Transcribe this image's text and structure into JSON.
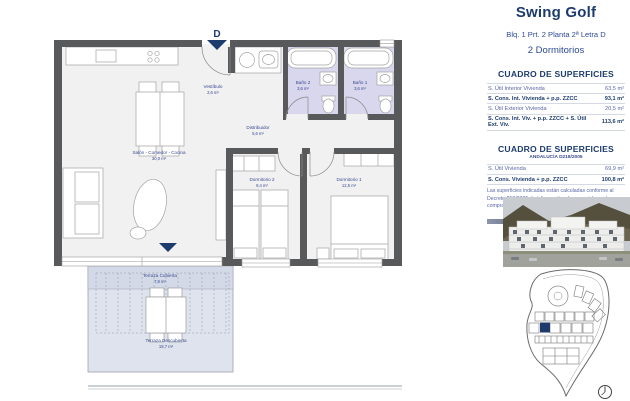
{
  "colors": {
    "navy": "#1d3c6e",
    "blue_text": "#5a66a8",
    "wall_gray": "#58595b",
    "room_fill": "#f1f1f2",
    "bath_fill": "#d9d7ed",
    "terrace_fill": "#dfe3ed",
    "marker_blue": "#1e3a6d"
  },
  "header": {
    "project": "Swing Golf",
    "unit": "Blq. 1 Prt. 2 Planta 2ª Letra D",
    "bedrooms": "2 Dormitorios"
  },
  "table1": {
    "title": "CUADRO DE SUPERFICIES",
    "rows": [
      {
        "label": "S. Útil Interior Vivienda",
        "value": "63,5 m²"
      },
      {
        "label": "S. Cons. Int. Vivienda + p.p. ZZCC",
        "value": "93,1 m²"
      },
      {
        "label": "S. Útil Exterior Vivienda",
        "value": "20,5 m²"
      },
      {
        "label": "S. Cons. Int. Viv. + p.p. ZZCC + S. Útil Ext. Viv.",
        "value": "113,6 m²"
      }
    ]
  },
  "table2": {
    "title": "CUADRO DE SUPERFICIES",
    "subtitle": "ANDALUCÍA D218/2005",
    "rows": [
      {
        "label": "S. Útil Vivienda",
        "value": "69,9 m²"
      },
      {
        "label": "S. Cons. Vivienda + p.p. ZZCC",
        "value": "100,8 m²"
      }
    ],
    "note": "Las superficies indicadas están calculadas conforme al Decreto 218/2005 de información al consumidor en la compraventa y arrendamiento de viviendas en Andalucía."
  },
  "floorplan": {
    "unit_letter": "D",
    "rooms": {
      "vestibulo": {
        "name": "Vestíbulo",
        "area": "2,6 m²"
      },
      "salon": {
        "name": "Salón - Comedor - Cocina",
        "area": "30,0 m²"
      },
      "distribuidor": {
        "name": "Distribuidor",
        "area": "5,6 m²"
      },
      "bano2": {
        "name": "Baño 2",
        "area": "3,6 m²"
      },
      "bano1": {
        "name": "Baño 1",
        "area": "3,6 m²"
      },
      "dormitorio2": {
        "name": "Dormitorio 2",
        "area": "9,4 m²"
      },
      "dormitorio1": {
        "name": "Dormitorio 1",
        "area": "12,5 m²"
      },
      "terraza_cubierta": {
        "name": "Terraza Cubierta",
        "area": "7,8 m²"
      },
      "terraza_descubierta": {
        "name": "Terraza Descubierta",
        "area": "18,7 m²"
      }
    }
  }
}
